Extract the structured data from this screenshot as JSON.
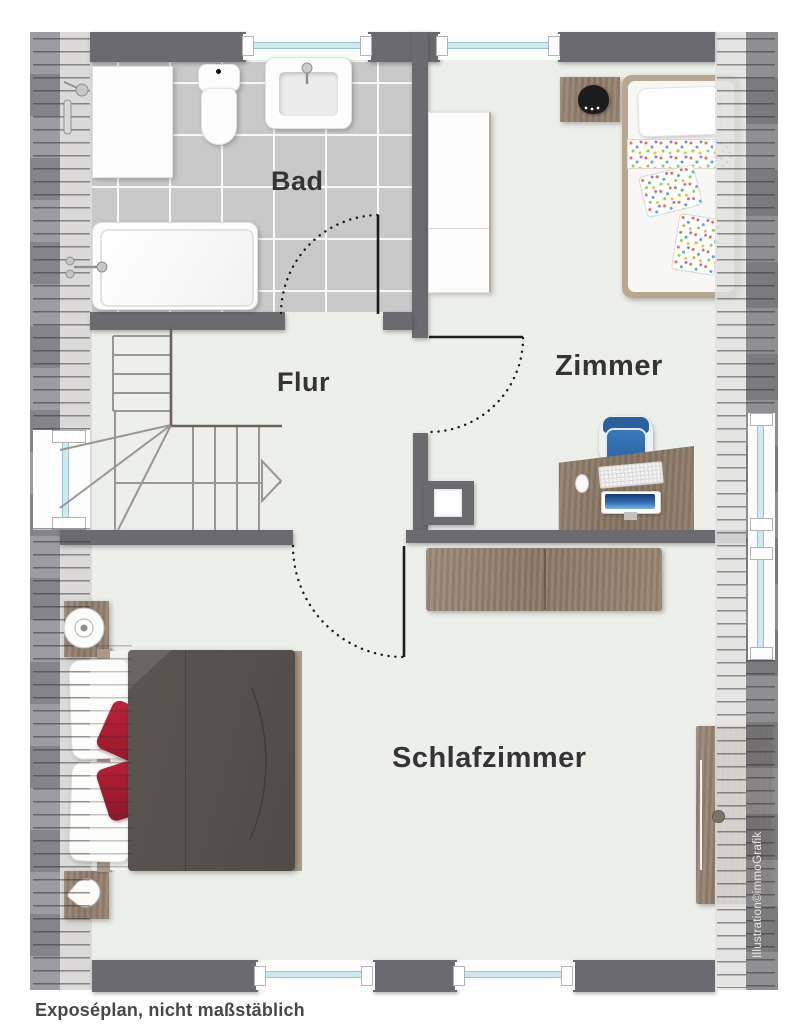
{
  "labels": {
    "bathroom": "Bad",
    "hallway": "Flur",
    "room": "Zimmer",
    "bedroom": "Schlafzimmer"
  },
  "caption": "Exposéplan, nicht maßstäblich",
  "watermark": "Illustration©immoGrafik",
  "colors": {
    "wall": "#6b6a6e",
    "floor": "#edefeb",
    "bathroom_tile": "#c9c9c9",
    "window_glass": "#cfe9f0",
    "wood_furniture": "#96826f",
    "duvet": "#56514b",
    "accent_pillow_red": "#a81f30",
    "office_chair_blue": "#2f6cab",
    "kids_lamp_black": "#1c1c1e",
    "label_text": "#343437"
  }
}
